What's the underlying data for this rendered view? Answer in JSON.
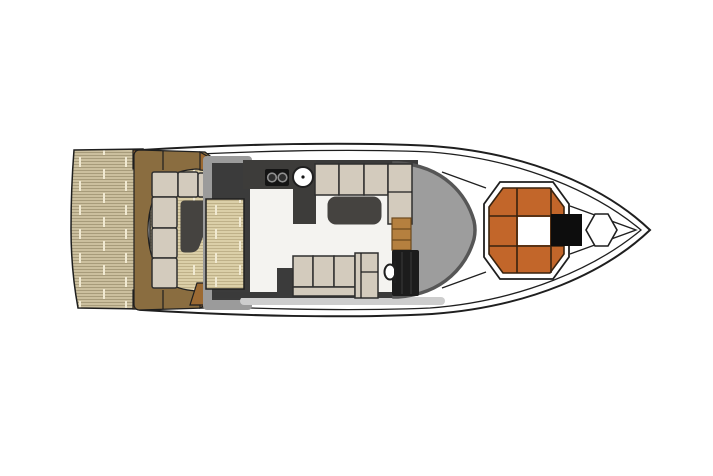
{
  "diagram": {
    "kind": "yacht-deck-floor-plan",
    "canvas": {
      "width": 713,
      "height": 476
    },
    "colors": {
      "line": "#1f1f1f",
      "hull_fill": "#ffffff",
      "platform_base": "#cbbf9e",
      "platform_stripe": "#a79b7a",
      "plank_seam": "#f0e9d2",
      "cockpit_base": "#dbcfa8",
      "cockpit_stripe": "#bfb189",
      "structure_brown": "#8a6d40",
      "wedge_brown": "#9c6a33",
      "cushion": "#d3cbbd",
      "cushion_line": "#2f2f2f",
      "table_dark": "#454340",
      "frame_gray": "#9b9b9b",
      "bulkhead_dark": "#3b3b3b",
      "floor": "#f4f3f0",
      "wall_dark": "#3a3a3a",
      "counter": "#3d3c3a",
      "stove": "#141414",
      "burner": "#2e2e2e",
      "burner_ring": "#909090",
      "windshield": "#9d9d9d",
      "windshield_edge": "#565656",
      "cabinet_brown": "#b5803f",
      "cabinet_line": "#6e4a1e",
      "seat_black": "#1c1c1c",
      "sunpad_orange": "#c2662a",
      "sunpad_grid": "#38220e",
      "hatch_black": "#0d0d0d",
      "band_gray": "#cdcdcd"
    },
    "areas": [
      {
        "id": "hull"
      },
      {
        "id": "swim-platform"
      },
      {
        "id": "transom-lockers"
      },
      {
        "id": "cockpit-deck"
      },
      {
        "id": "cockpit-surround"
      },
      {
        "id": "cockpit-seating"
      },
      {
        "id": "cockpit-table"
      },
      {
        "id": "salon-entry-steps"
      },
      {
        "id": "salon"
      },
      {
        "id": "galley-counter"
      },
      {
        "id": "stove"
      },
      {
        "id": "sink"
      },
      {
        "id": "salon-sofa-forward"
      },
      {
        "id": "coffee-table"
      },
      {
        "id": "salon-sofa-aft"
      },
      {
        "id": "helm-console"
      },
      {
        "id": "helm-seat"
      },
      {
        "id": "steering-wheel"
      },
      {
        "id": "windshield"
      },
      {
        "id": "bow-sunpad"
      },
      {
        "id": "bow-walkway"
      },
      {
        "id": "anchor-hatch"
      }
    ]
  }
}
